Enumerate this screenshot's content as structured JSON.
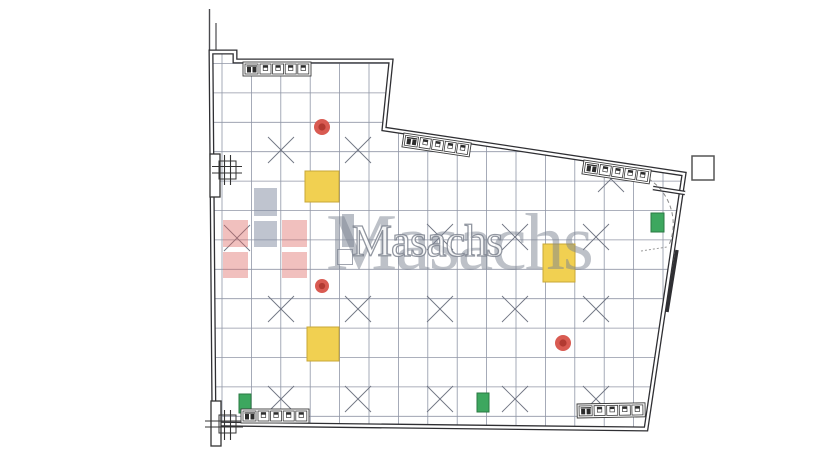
{
  "watermark": {
    "brand_large": "Masachs",
    "brand_small": "Masachs",
    "logo_squares": [
      {
        "x": 254,
        "y": 188,
        "w": 23,
        "h": 28,
        "c": "gray"
      },
      {
        "x": 254,
        "y": 221,
        "w": 23,
        "h": 26,
        "c": "gray"
      },
      {
        "x": 223,
        "y": 220,
        "w": 25,
        "h": 27,
        "c": "red"
      },
      {
        "x": 282,
        "y": 220,
        "w": 25,
        "h": 27,
        "c": "red"
      },
      {
        "x": 223,
        "y": 252,
        "w": 25,
        "h": 26,
        "c": "red"
      },
      {
        "x": 282,
        "y": 252,
        "w": 25,
        "h": 26,
        "c": "red"
      }
    ],
    "small_logo_bar": {
      "x": 342,
      "y": 214,
      "w": 12,
      "h": 33
    },
    "small_logo_box": {
      "x": 337,
      "y": 249,
      "w": 14,
      "h": 14
    }
  },
  "colors": {
    "wall": "#2f2f33",
    "grid": "#9096a6",
    "cross": "#6f7482",
    "yellow_fill": "#f1d051",
    "yellow_border": "#c8a737",
    "red_fill": "#d95b52",
    "red_core": "#b23a31",
    "green_fill": "#3da75f",
    "green_border": "#2a7a43",
    "watermark_red": "rgba(222,106,100,0.42)",
    "watermark_gray": "rgba(128,138,160,0.5)"
  },
  "plan": {
    "grid": {
      "x0": 222,
      "y0": 63.5,
      "spacing": 29.4,
      "x_max": 700,
      "y_max": 425
    },
    "cross_cells": [
      [
        281,
        150
      ],
      [
        358,
        150
      ],
      [
        611,
        179
      ],
      [
        237,
        238
      ],
      [
        440,
        237
      ],
      [
        515,
        237
      ],
      [
        596,
        237
      ],
      [
        281,
        309
      ],
      [
        358,
        309
      ],
      [
        440,
        309
      ],
      [
        515,
        309
      ],
      [
        596,
        309
      ],
      [
        281,
        399
      ],
      [
        358,
        399
      ],
      [
        440,
        399
      ],
      [
        515,
        399
      ],
      [
        596,
        399
      ]
    ],
    "yellow_squares": [
      {
        "x": 305,
        "y": 171,
        "w": 34,
        "h": 31
      },
      {
        "x": 543,
        "y": 244,
        "w": 32,
        "h": 38
      },
      {
        "x": 307,
        "y": 327,
        "w": 32,
        "h": 34
      }
    ],
    "red_circles": [
      {
        "cx": 322,
        "cy": 127,
        "r": 8
      },
      {
        "cx": 322,
        "cy": 286,
        "r": 7
      },
      {
        "cx": 563,
        "cy": 343,
        "r": 8
      }
    ],
    "green_rects": [
      {
        "x": 651,
        "y": 213,
        "w": 13,
        "h": 19
      },
      {
        "x": 239,
        "y": 394,
        "w": 12,
        "h": 19
      },
      {
        "x": 477,
        "y": 393,
        "w": 12,
        "h": 19
      }
    ],
    "white_square": {
      "x": 692,
      "y": 156,
      "w": 22,
      "h": 24
    },
    "strips": [
      {
        "x": 243,
        "y": 62,
        "angle": 0
      },
      {
        "x": 404,
        "y": 133,
        "angle": 8.5
      },
      {
        "x": 584,
        "y": 160,
        "angle": 8.5
      },
      {
        "x": 241,
        "y": 409,
        "angle": 0
      },
      {
        "x": 577,
        "y": 404,
        "angle": -1
      }
    ]
  }
}
